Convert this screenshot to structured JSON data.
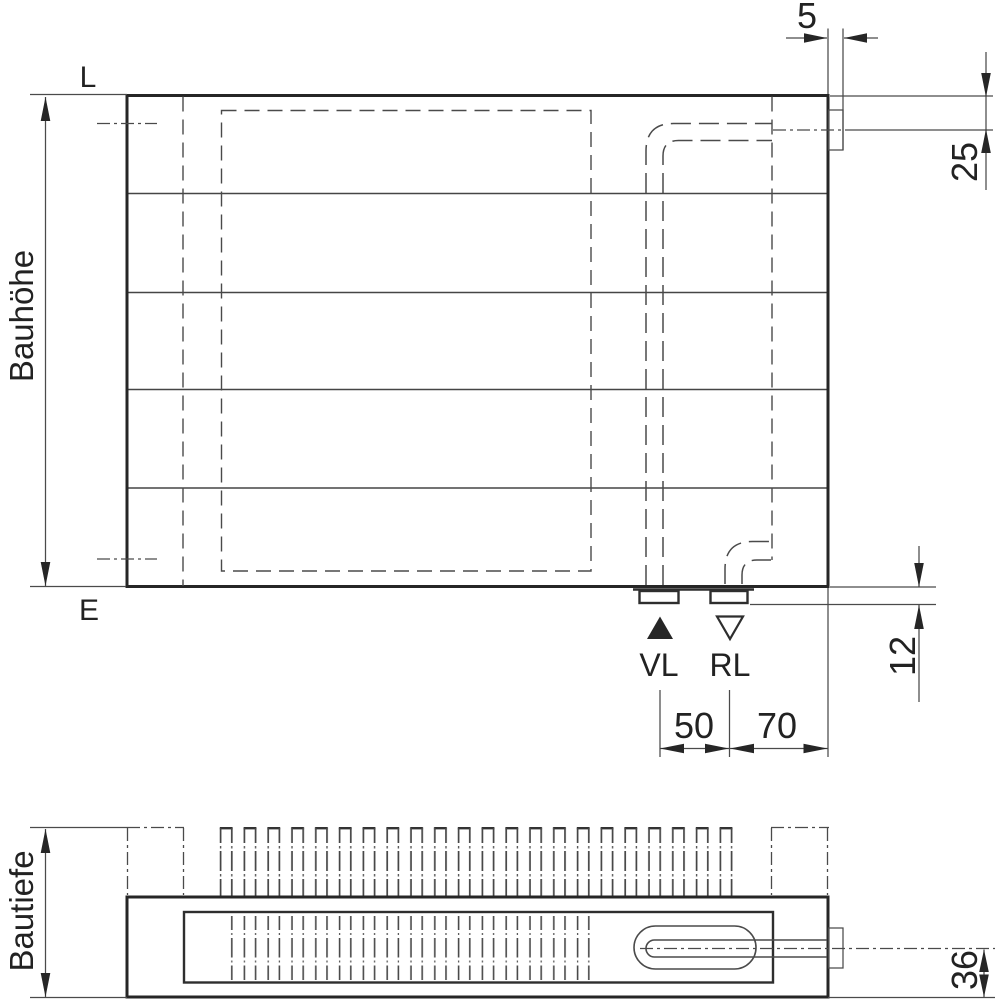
{
  "style": {
    "ink": "#262626",
    "background": "#ffffff"
  },
  "front": {
    "labels": {
      "l": "L",
      "e": "E",
      "bauhoehe": "Bauhöhe",
      "vl": "VL",
      "rl": "RL"
    },
    "dims": {
      "d5": "5",
      "d25": "25",
      "d12": "12",
      "d50": "50",
      "d70": "70"
    }
  },
  "section": {
    "labels": {
      "bautiefe": "Bautiefe"
    },
    "dims": {
      "d36": "36"
    }
  }
}
